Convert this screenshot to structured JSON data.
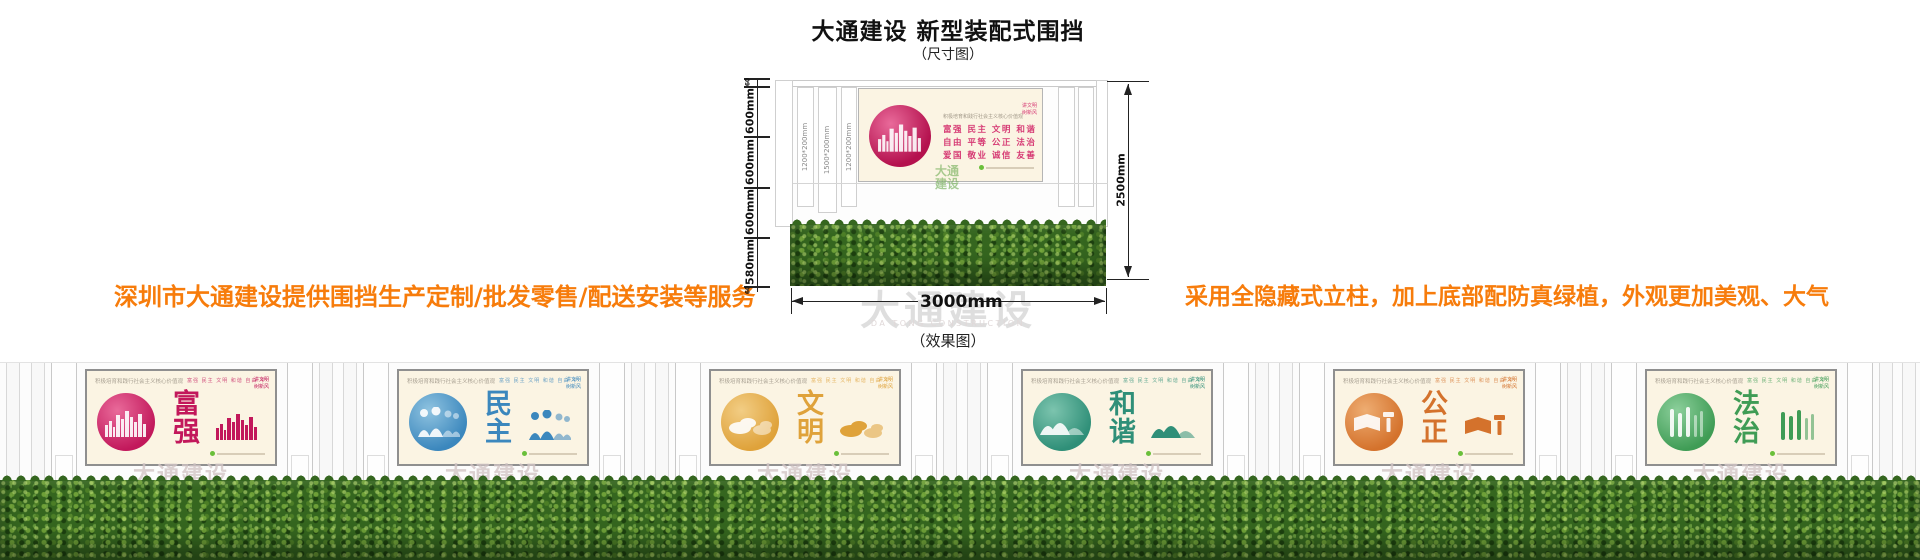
{
  "header": {
    "title": "大通建设 新型装配式围挡",
    "subtitle": "（尺寸图）"
  },
  "notes": {
    "left": "深圳市大通建设提供围挡生产定制/批发零售/配送安装等服务",
    "right": "采用全隐藏式立柱，加上底部配防真绿植，外观更加美观、大气"
  },
  "dimension_figure": {
    "left_segments": [
      "60",
      "600mm",
      "600mm",
      "600mm",
      "580mm",
      "60"
    ],
    "height_label": "2500mm",
    "width_label": "3000mm",
    "column_labels": [
      "1200*200mm",
      "1500*200mm",
      "1200*200mm"
    ],
    "poster": {
      "slogan": "积极培育和践行社会主义核心价值观",
      "corner": "讲文明 树新风",
      "lines": [
        "富强 民主 文明 和谐",
        "自由 平等 公正 法治",
        "爱国 敬业 诚信 友善"
      ]
    },
    "green_watermark": "大通建设"
  },
  "effect_label": "（效果图）",
  "watermark": {
    "cn": "大通建设",
    "en": "DA TONG CONSTRUCTION"
  },
  "poster_common": {
    "slogan": "积极培育和践行社会主义核心价值观",
    "values_row": "富强 民主 文明 和谐 自由 平等 公正 法治 爱国 敬业 诚信 友善",
    "corner": "讲文明 树新风"
  },
  "panels": [
    {
      "word": "富强",
      "icon": "city-skyline",
      "color": "#c2185b",
      "color2": "#e96a9a"
    },
    {
      "word": "民主",
      "icon": "people",
      "color": "#3b87bd",
      "color2": "#8fc3e0"
    },
    {
      "word": "文明",
      "icon": "clouds",
      "color": "#dfa23a",
      "color2": "#f2cd84"
    },
    {
      "word": "和谐",
      "icon": "mountains",
      "color": "#2f8f78",
      "color2": "#7cc4ae"
    },
    {
      "word": "公正",
      "icon": "book-gavel",
      "color": "#d4722c",
      "color2": "#eead72"
    },
    {
      "word": "法治",
      "icon": "bamboo",
      "color": "#3f9c55",
      "color2": "#8ccf9b"
    }
  ]
}
